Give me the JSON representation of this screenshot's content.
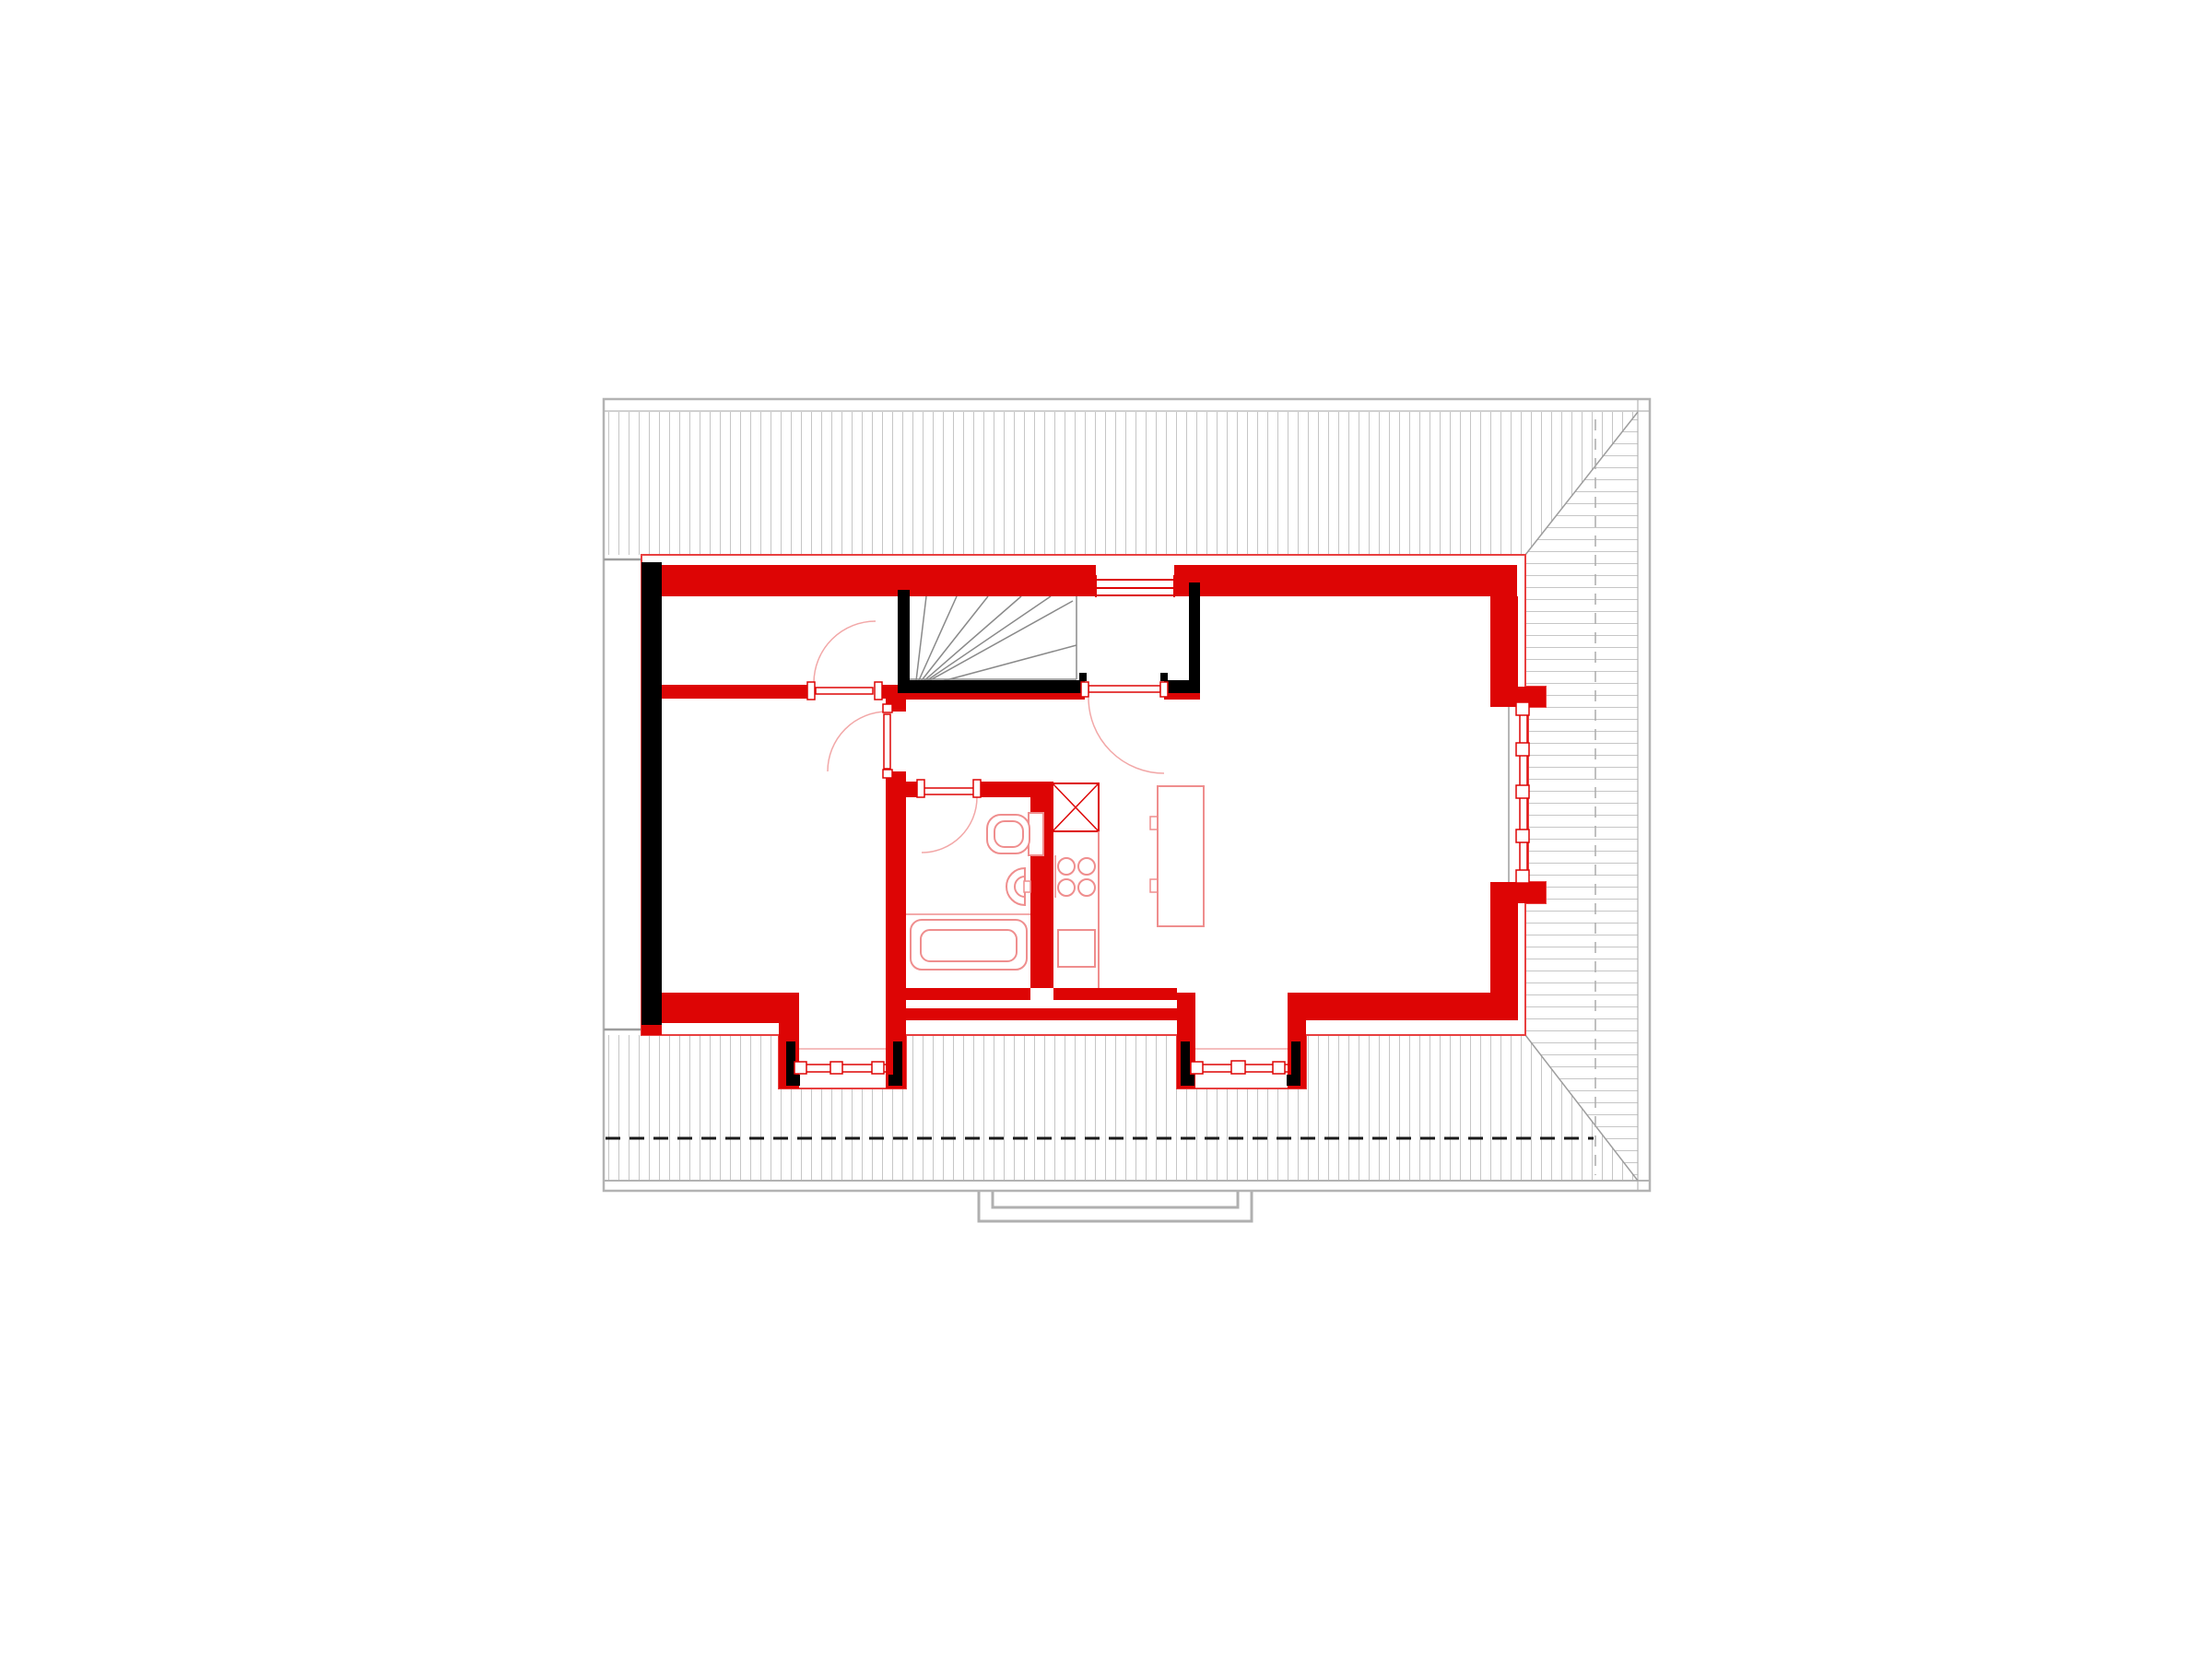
{
  "document": {
    "title": "Attic floor plan drawing",
    "type": "architectural-floor-plan",
    "background": "#ffffff"
  },
  "colors": {
    "wall_new": "#dd0505",
    "wall_outline_thin": "#e84040",
    "wall_existing": "#000000",
    "fixture": "#ef8e8e",
    "fixture_strong": "#dd0505",
    "door_swing": "#f2a8a8",
    "roof_hatch": "#c6c6c6",
    "roof_edge": "#9d9d9d",
    "roof_border": "#b3b3b3",
    "ridge_line": "#ababab",
    "section_line": "#1a1a1a",
    "stair_tread": "#8a8a8a",
    "porch": "#b0b0b0",
    "floor": "#ffffff"
  },
  "legend": {
    "red_walls": "new construction walls",
    "black_walls": "existing walls",
    "hatched_area": "roof surface",
    "dashed_black_line": "section line",
    "dashed_gray_line": "roof ridge line"
  },
  "plan": {
    "rooms": [
      {
        "name": "room-upper-left"
      },
      {
        "name": "room-lower-left"
      },
      {
        "name": "stairwell"
      },
      {
        "name": "hallway"
      },
      {
        "name": "bathroom"
      },
      {
        "name": "kitchen-living-room"
      }
    ],
    "stairs": {
      "type": "winder-stair",
      "tread_lines": 7
    },
    "doors": {
      "count": 4
    },
    "windows": {
      "count": 4,
      "positions": [
        "top-wall",
        "right-bay",
        "left-dormer",
        "right-dormer"
      ]
    },
    "dormers": {
      "count": 2
    },
    "fixtures": [
      "bathtub",
      "washbasin",
      "toilet",
      "ventilation-shaft",
      "stove-4-burners",
      "kitchen-sink",
      "kitchen-island"
    ]
  }
}
